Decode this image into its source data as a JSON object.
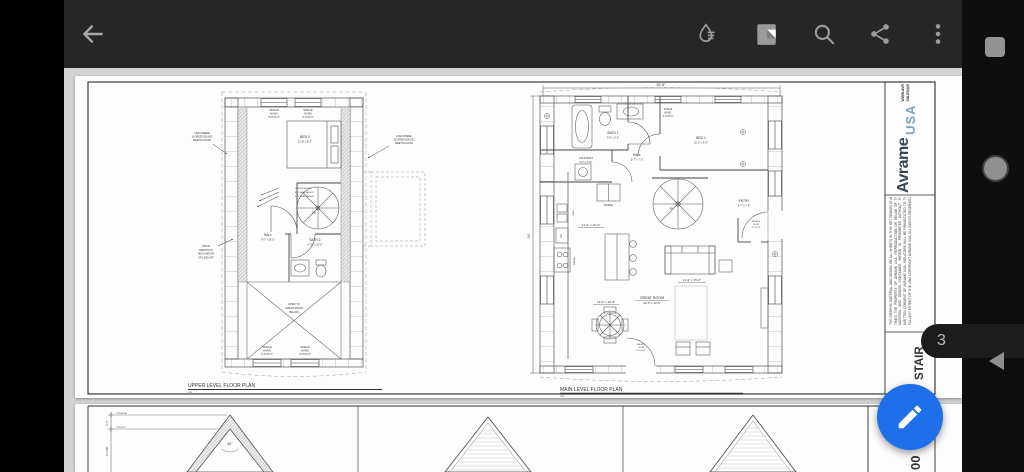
{
  "toolbar": {
    "icons": [
      "back-arrow",
      "ink-drop",
      "page-layout",
      "search",
      "share",
      "more-options"
    ]
  },
  "viewer": {
    "page_badge": "3",
    "nav_arrow": "previous-page",
    "fab": "edit-annotate"
  },
  "colors": {
    "fab_blue": "#1f6fea",
    "logo_blue": "#7fa3bd",
    "toolbar_gray": "#262626"
  },
  "sheet1": {
    "window": {
      "l1": "SINGLE",
      "l2": "HUNG",
      "l3": "3'-0\"x5'-0\""
    },
    "upper": {
      "title": "UPPER LEVEL FLOOR PLAN",
      "scale": "NTS",
      "bed2": {
        "name": "BED 2",
        "dim": "11'-8\" x 9'-3\""
      },
      "hall": {
        "name": "HALL",
        "dim": "9'-7\" x 15'-2\""
      },
      "bath2": {
        "name": "BATH 2",
        "dim": "6'-10\" x 10'-6\""
      },
      "dn": "DN",
      "open": {
        "l1": "OPEN TO",
        "l2": "GREAT ROOM",
        "l3": "BELOW"
      },
      "sloped": {
        "l1": "LINE WHERE",
        "l2": "SLOPED CEILING",
        "l3": "MEETS FLOOR"
      },
      "hatch": {
        "l1": "HATCH",
        "l2": "DENOTES 5'",
        "l3": "HEAD HEIGHT",
        "l4": "OR LESS AFF"
      },
      "heights": {
        "l1": "CEILING HEIGHT",
        "l2": "8'-0\" HEAD HEIGHT",
        "l3": "6'-0\" HEAD HEIGHT"
      }
    },
    "main": {
      "title": "MAIN LEVEL FLOOR PLAN",
      "scale": "NTS",
      "dim_top": "30'-6\"",
      "dim_left": "34'",
      "bath1": {
        "name": "BATH 1",
        "dim": "9'-9\" x 5'-0\""
      },
      "bed1": {
        "name": "BED 1",
        "dim": "11'-2\" x 9'-3\""
      },
      "laundry": {
        "name": "LAUNDRY",
        "dim": "6'-2\" x 4'-10\""
      },
      "hall": {
        "name": "HALL",
        "dim": "5'-7\" x 7'-2\""
      },
      "entry": {
        "name": "ENTRY",
        "dim": "6'-7\" x 7'-9\""
      },
      "great": {
        "name": "GREAT ROOM",
        "dim": "22'-5\" x 19'-6\""
      },
      "kitchen_dim": "11'-2\" x 12'-2\"",
      "living_dim": "11'-2\" x 15'-6\"",
      "dining_dim": "13'-2\" x 10'-8\"",
      "fridge": "FRIDGE",
      "sink": "SINK",
      "dw": "DW",
      "range": "RANGE",
      "up": "UP",
      "french": {
        "l1": "FRENCH",
        "l2": "DOOR",
        "l3": "6'-0\"x6'-8\""
      }
    },
    "title_block": {
      "brand": "Avrame",
      "brand_sub": "USA",
      "website": "WWW.AVRAMEUSA.COM",
      "email": "SALES@AVRAMEUSA.COM",
      "disclaimer": "THE GRAPHIC MATERIAL AND DESIGN ON ALL SHEETS IN THIS SET REMAIN AT ALL TIMES THE PROPERTY OF AVRAME USA. REPRODUCTION OR REUSE OF THE MATERIAL AND DESIGN CONTAINED HEREIN IS PROHIBITED WITHOUT THE WRITTEN CONSENT OF AVRAME USA. VIOLATORS WILL BE PROSECUTED TO THE FULLEST EXTENT OF THE LAW. COPYRIGHT AVRAME USA, ALL RIGHTS RESERVED.",
      "sheet_title": "STAIR"
    }
  },
  "sheet2": {
    "angle": "60°",
    "dim_upper": "2'-5\"",
    "dim_lower": "6'-3 5/8\"",
    "level_top": "TOP/RIDGE",
    "level_mid": "TOP/LOFT",
    "sheet_num": "00"
  }
}
